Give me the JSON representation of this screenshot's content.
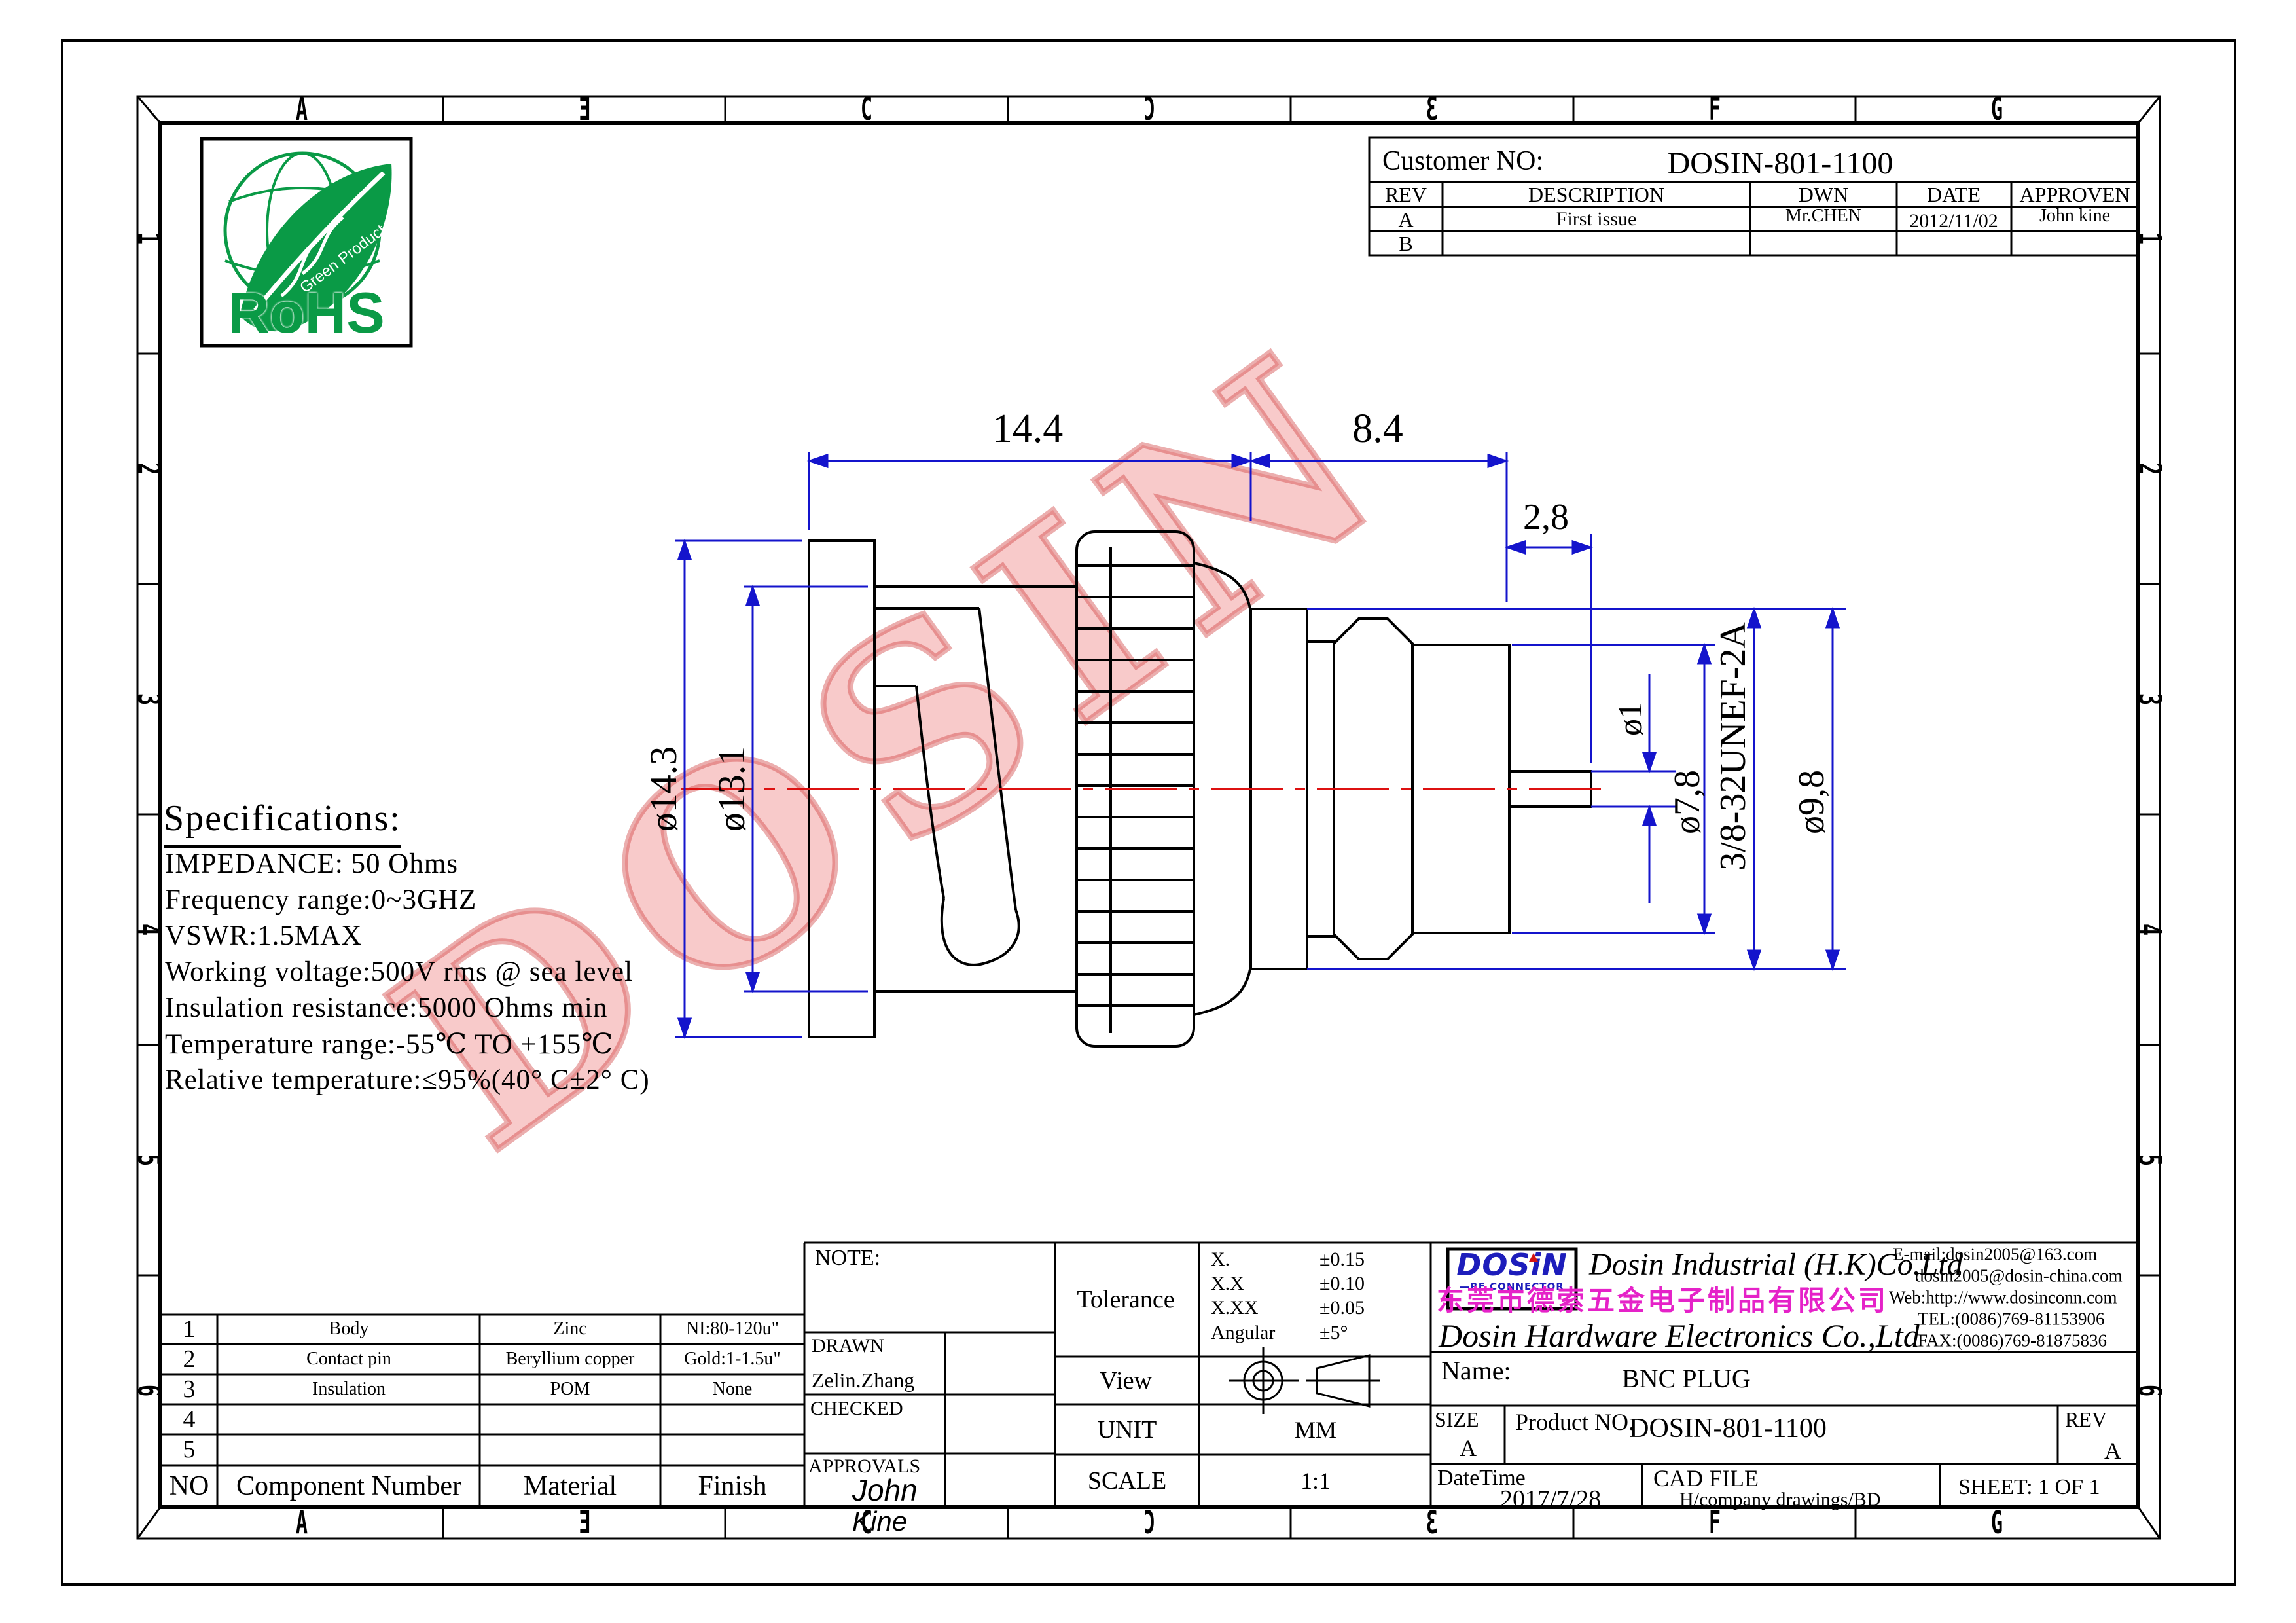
{
  "border": {
    "top_letters": [
      "A",
      "Ǝ",
      "C",
      "Ɔ",
      "Ɛ",
      "F",
      "G"
    ],
    "bottom_letters": [
      "A",
      "Ǝ",
      "C",
      "Ɔ",
      "Ɛ",
      "F",
      "G"
    ],
    "left_numbers": [
      "1",
      "2",
      "3",
      "4",
      "5",
      "6"
    ],
    "right_numbers": [
      "1",
      "2",
      "3",
      "4",
      "5",
      "6"
    ]
  },
  "rohs": {
    "label": "RoHS",
    "sub": "Green Product"
  },
  "customer_block": {
    "label": "Customer NO:",
    "value": "DOSIN-801-1100",
    "headers": [
      "REV",
      "DESCRIPTION",
      "DWN",
      "DATE",
      "APPROVEN"
    ],
    "row_a": {
      "rev": "A",
      "description": "First issue",
      "dwn": "Mr.CHEN",
      "date": "2012/11/02",
      "approven": "John kine"
    },
    "row_b": {
      "rev": "B",
      "description": "",
      "dwn": "",
      "date": "",
      "approven": ""
    }
  },
  "dimensions": {
    "len_main": "14.4",
    "len_rear": "8.4",
    "len_pin": "2,8",
    "dia_flange": "ø14.3",
    "dia_shell": "ø13.1",
    "dia_pin": "ø1",
    "dia_body": "ø7,8",
    "dia_collar": "ø9,8",
    "thread": "3/8-32UNEF-2A"
  },
  "watermark": "DOSIN",
  "specifications": {
    "title": "Specifications:",
    "lines": [
      "IMPEDANCE: 50 Ohms",
      "Frequency range:0~3GHZ",
      "VSWR:1.5MAX",
      "Working voltage:500V rms @ sea level",
      "Insulation resistance:5000 Ohms min",
      "Temperature range:-55℃ TO +155℃",
      "Relative temperature:≤95%(40° C±2° C)"
    ]
  },
  "parts_table": {
    "headers": {
      "no": "NO",
      "component": "Component Number",
      "material": "Material",
      "finish": "Finish"
    },
    "rows": [
      {
        "no": "1",
        "component": "Body",
        "material": "Zinc",
        "finish": "NI:80-120u\""
      },
      {
        "no": "2",
        "component": "Contact pin",
        "material": "Beryllium copper",
        "finish": "Gold:1-1.5u\""
      },
      {
        "no": "3",
        "component": "Insulation",
        "material": "POM",
        "finish": "None"
      },
      {
        "no": "4",
        "component": "",
        "material": "",
        "finish": ""
      },
      {
        "no": "5",
        "component": "",
        "material": "",
        "finish": ""
      }
    ]
  },
  "title_block": {
    "note_label": "NOTE:",
    "drawn_label": "DRAWN",
    "drawn_by": "Zelin.Zhang",
    "checked_label": "CHECKED",
    "approvals_label": "APPROVALS",
    "approved_sig_1": "John",
    "approved_sig_2": "Kine",
    "tolerance_label": "Tolerance",
    "tolerance_rows": [
      {
        "range": "X.",
        "value": "±0.15"
      },
      {
        "range": "X.X",
        "value": "±0.10"
      },
      {
        "range": "X.XX",
        "value": "±0.05"
      },
      {
        "range": "Angular",
        "value": "±5°"
      }
    ],
    "view_label": "View",
    "unit_label": "UNIT",
    "unit_value": "MM",
    "scale_label": "SCALE",
    "scale_value": "1:1",
    "company": {
      "logo_main": "DOSiN",
      "logo_sub": "—RF CONNECTOR",
      "name_en1": "Dosin Industrial (H.K)Co.Ltd",
      "name_cn": "东莞市德索五金电子制品有限公司",
      "name_en2": "Dosin Hardware Electronics Co.,Ltd",
      "email1": "E-mail:dosin2005@163.com",
      "email2": "dosin2005@dosin-china.com",
      "web": "Web:http://www.dosinconn.com",
      "tel": "TEL:(0086)769-81153906",
      "fax": "FAX:(0086)769-81875836"
    },
    "name_label": "Name:",
    "name_value": "BNC PLUG",
    "size_label": "SIZE",
    "size_value": "A",
    "product_label": "Product NO.",
    "product_value": "DOSIN-801-1100",
    "rev_label": "REV",
    "rev_value": "A",
    "datetime_label": "DateTime",
    "datetime_value": "2017/7/28",
    "cadfile_label": "CAD FILE",
    "cadfile_value": "H/company drawings/BD",
    "sheet_label": "SHEET:",
    "sheet_value": "1 OF 1"
  }
}
